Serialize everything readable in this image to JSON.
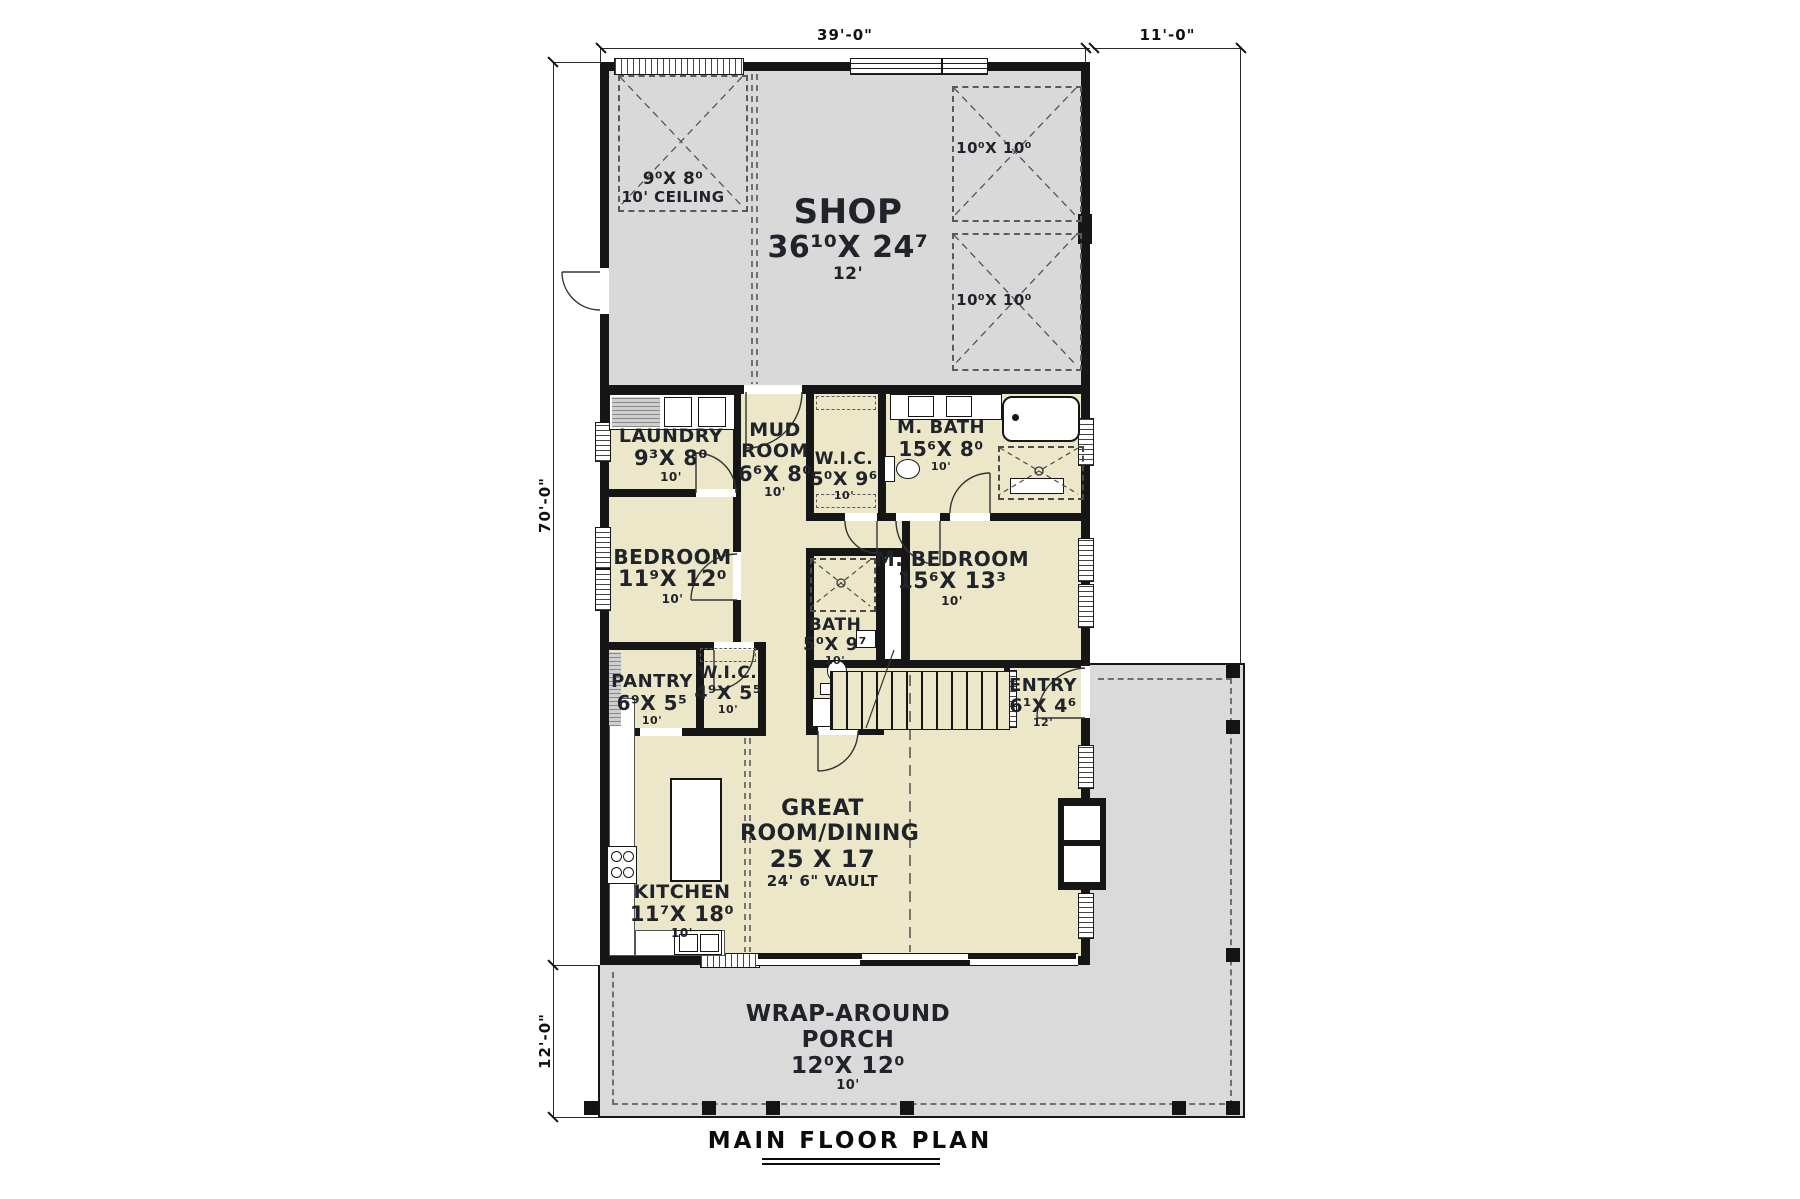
{
  "page": {
    "title": "MAIN FLOOR PLAN"
  },
  "dims": {
    "top_main": "39'-0\"",
    "top_right": "11'-0\"",
    "left_main": "70'-0\"",
    "left_lower": "12'-0\""
  },
  "shop": {
    "name": "SHOP",
    "size": "36¹⁰X 24⁷",
    "ceiling": "12'",
    "loft1_size": "9⁰X 8⁰",
    "loft1_note": "10' CEILING",
    "loft2_size": "10⁰X 10⁰",
    "loft3_size": "10⁰X 10⁰"
  },
  "rooms": {
    "laundry": {
      "name": "LAUNDRY",
      "size": "9³X 8⁰",
      "ceiling": "10'"
    },
    "mud": {
      "name": "MUD ROOM",
      "size": "6⁶X 8⁰",
      "ceiling": "10'"
    },
    "wic_master": {
      "name": "W.I.C.",
      "size": "5⁰X 9⁶",
      "ceiling": "10'"
    },
    "mbath": {
      "name": "M. BATH",
      "size": "15⁶X 8⁰",
      "ceiling": "10'"
    },
    "bedroom": {
      "name": "BEDROOM",
      "size": "11⁹X 12⁰",
      "ceiling": "10'"
    },
    "mbedroom": {
      "name": "M. BEDROOM",
      "size": "15⁶X 13³",
      "ceiling": "10'"
    },
    "bath": {
      "name": "BATH",
      "size": "5⁰X 9⁷",
      "ceiling": "10'"
    },
    "pantry": {
      "name": "PANTRY",
      "size": "6⁹X 5⁵",
      "ceiling": "10'"
    },
    "wic_bedroom": {
      "name": "W.I.C.",
      "size": "4⁹X 5⁵",
      "ceiling": "10'"
    },
    "entry": {
      "name": "ENTRY",
      "size": "6¹X 4⁶",
      "ceiling": "12'"
    },
    "kitchen": {
      "name": "KITCHEN",
      "size": "11⁷X 18⁰",
      "ceiling": "10'"
    },
    "great": {
      "name": "GREAT ROOM/DINING",
      "size": "25 X 17",
      "ceiling": "24' 6\" VAULT"
    },
    "porch": {
      "name": "WRAP-AROUND PORCH",
      "size": "12⁰X 12⁰",
      "ceiling": "10'"
    }
  },
  "colors": {
    "room_fill": "#ebe7c8",
    "shop_fill": "#d9d9d9",
    "porch_fill": "#dadada",
    "wall": "#161616"
  }
}
